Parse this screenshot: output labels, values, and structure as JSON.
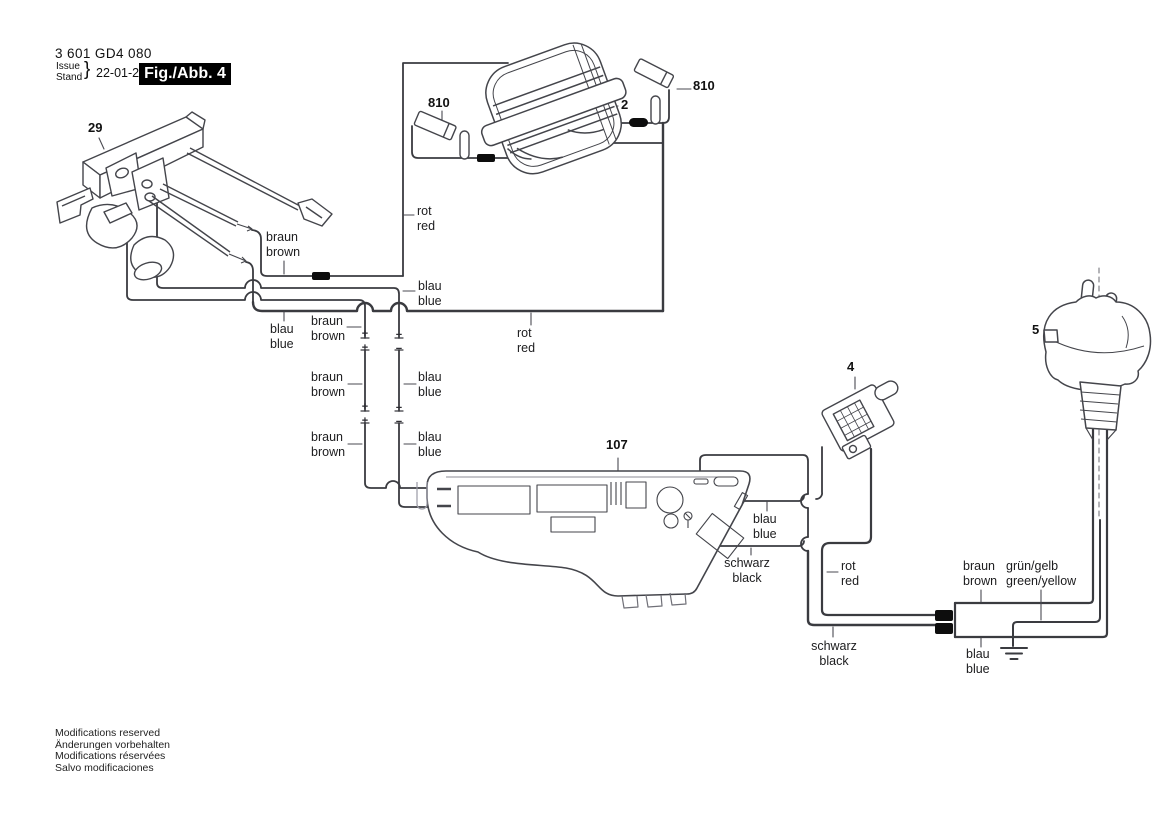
{
  "header": {
    "part_number": "3 601 GD4 080",
    "issue_label": "Issue",
    "stand_label": "Stand",
    "brace": "}",
    "date": "22-01-26",
    "figure_label": "Fig./Abb. 4"
  },
  "part_labels": {
    "switch": "29",
    "brush_left": "810",
    "field": "2",
    "brush_right": "810",
    "connector": "4",
    "plug": "5",
    "module": "107"
  },
  "wire_labels": [
    {
      "line1": "rot",
      "line2": "red"
    },
    {
      "line1": "braun",
      "line2": "brown"
    },
    {
      "line1": "blau",
      "line2": "blue"
    },
    {
      "line1": "blau",
      "line2": "blue"
    },
    {
      "line1": "braun",
      "line2": "brown"
    },
    {
      "line1": "rot",
      "line2": "red"
    },
    {
      "line1": "braun",
      "line2": "brown"
    },
    {
      "line1": "blau",
      "line2": "blue"
    },
    {
      "line1": "braun",
      "line2": "brown"
    },
    {
      "line1": "blau",
      "line2": "blue"
    },
    {
      "line1": "blau",
      "line2": "blue"
    },
    {
      "line1": "schwarz",
      "line2": "black"
    },
    {
      "line1": "rot",
      "line2": "red"
    },
    {
      "line1": "schwarz",
      "line2": "black"
    },
    {
      "line1": "braun",
      "line2": "brown"
    },
    {
      "line1": "grün/gelb",
      "line2": "green/yellow"
    },
    {
      "line1": "blau",
      "line2": "blue"
    }
  ],
  "polarity": {
    "plus": "+",
    "minus": "−"
  },
  "footer": {
    "lines": [
      "Modifications reserved",
      "Änderungen vorbehalten",
      "Modifications réservées",
      "Salvo modificaciones"
    ]
  },
  "drawing": {
    "line_color": "#3a3b40",
    "thick_wire_color": "#35363c",
    "label_color": "#1c1c1e",
    "figure_bg": "#000000",
    "figure_fg": "#ffffff",
    "bead_color": "#0d0d0d"
  }
}
